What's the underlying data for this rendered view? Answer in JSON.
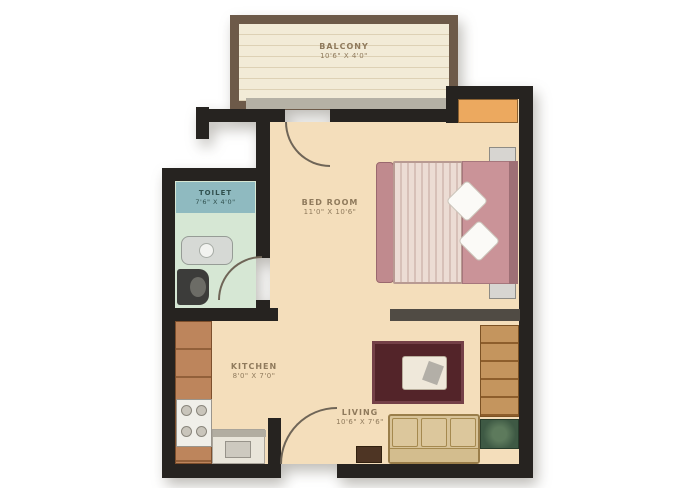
{
  "rooms": {
    "balcony": {
      "label": "BALCONY",
      "dims": "10'6\" X 4'0\""
    },
    "bedroom": {
      "label": "BED ROOM",
      "dims": "11'0\" X 10'6\""
    },
    "toilet": {
      "label": "TOILET",
      "dims": "7'6\" X 4'0\""
    },
    "kitchen": {
      "label": "KITCHEN",
      "dims": "8'0\" X 7'0\""
    },
    "living": {
      "label": "LIVING",
      "dims": "10'6\" X 7'6\""
    }
  },
  "colors": {
    "wall": "#262320",
    "partition": "#504b44",
    "floor": "#f4debb",
    "balcony-floor": "#f2ebd7",
    "balcony-border": "#6d5a49",
    "sill": "#b5b1a5",
    "toilet-floor": "#d6e7d4",
    "toilet-band": "#8fbac0",
    "toilet-text": "#31514f",
    "counter": "#bd855c",
    "bed-frame": "#c08a8e",
    "bed-head": "#ca9398",
    "mattress": "#ecdcd4",
    "wardrobe": "#eca95f",
    "rug": "#532429",
    "sofa": "#d8c398",
    "cabinet": "#c4955e",
    "green-unit": "#3e5944",
    "arc": "#6f6557",
    "label": "#8f7a5c"
  }
}
